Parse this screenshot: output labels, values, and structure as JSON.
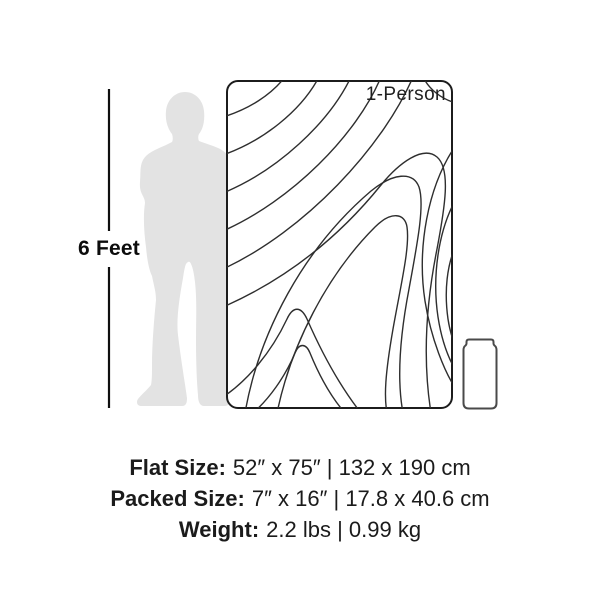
{
  "height_marker": {
    "label": "6 Feet"
  },
  "blanket": {
    "label": "1-Person"
  },
  "specs": {
    "lines": [
      {
        "label": "Flat Size:",
        "value": "52″ x 75″ | 132 x 190 cm"
      },
      {
        "label": "Packed Size:",
        "value": "7″ x 16″ | 17.8 x 40.6 cm"
      },
      {
        "label": "Weight:",
        "value": "2.2 lbs | 0.99 kg"
      }
    ]
  },
  "icons": {
    "human_silhouette": "standing-person-silhouette",
    "height_line": "vertical-measure-line",
    "topo_pattern": "topographic-contour-lines",
    "packed_roll": "packed-roll-outline"
  },
  "colors": {
    "silhouette": "#e3e3e3",
    "line": "#0f0f0f",
    "contour": "#2e2e2e",
    "blanket_border": "#1c1c1c",
    "blanket_fill": "#ffffff",
    "packed_outline": "#4a4a4a",
    "text": "#1b1b1b"
  }
}
